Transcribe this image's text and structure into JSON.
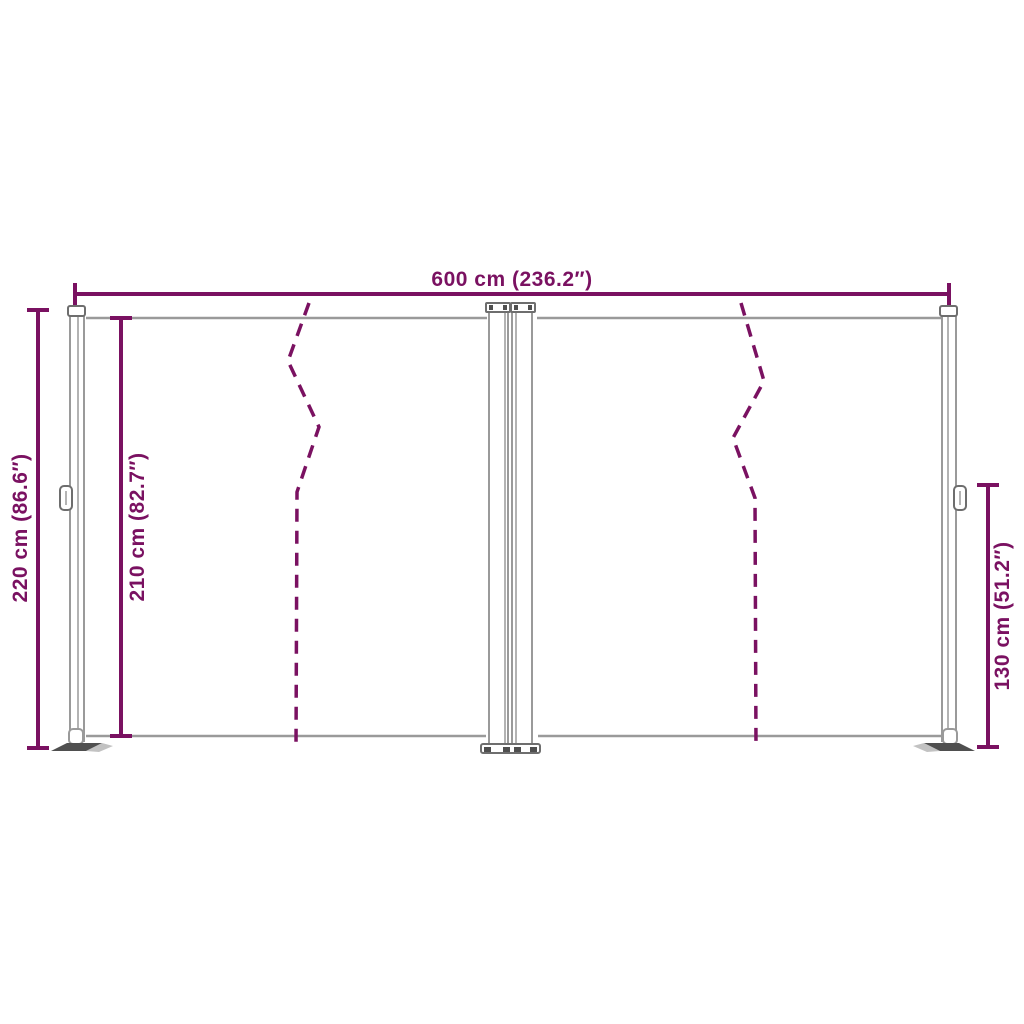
{
  "colors": {
    "accent": "#7a1161",
    "structure": "#9a9a9a",
    "structure_dark": "#4f4f4f",
    "structure_mid": "#c2c2c2",
    "hardware_outline": "#6e6e6e",
    "background": "#ffffff"
  },
  "dimensions": {
    "width_total": {
      "label": "600 cm (236.2″)"
    },
    "height_left_outer": {
      "label": "220 cm (86.6″)"
    },
    "height_left_inner": {
      "label": "210 cm (82.7″)"
    },
    "height_right": {
      "label": "130 cm (51.2″)"
    }
  }
}
